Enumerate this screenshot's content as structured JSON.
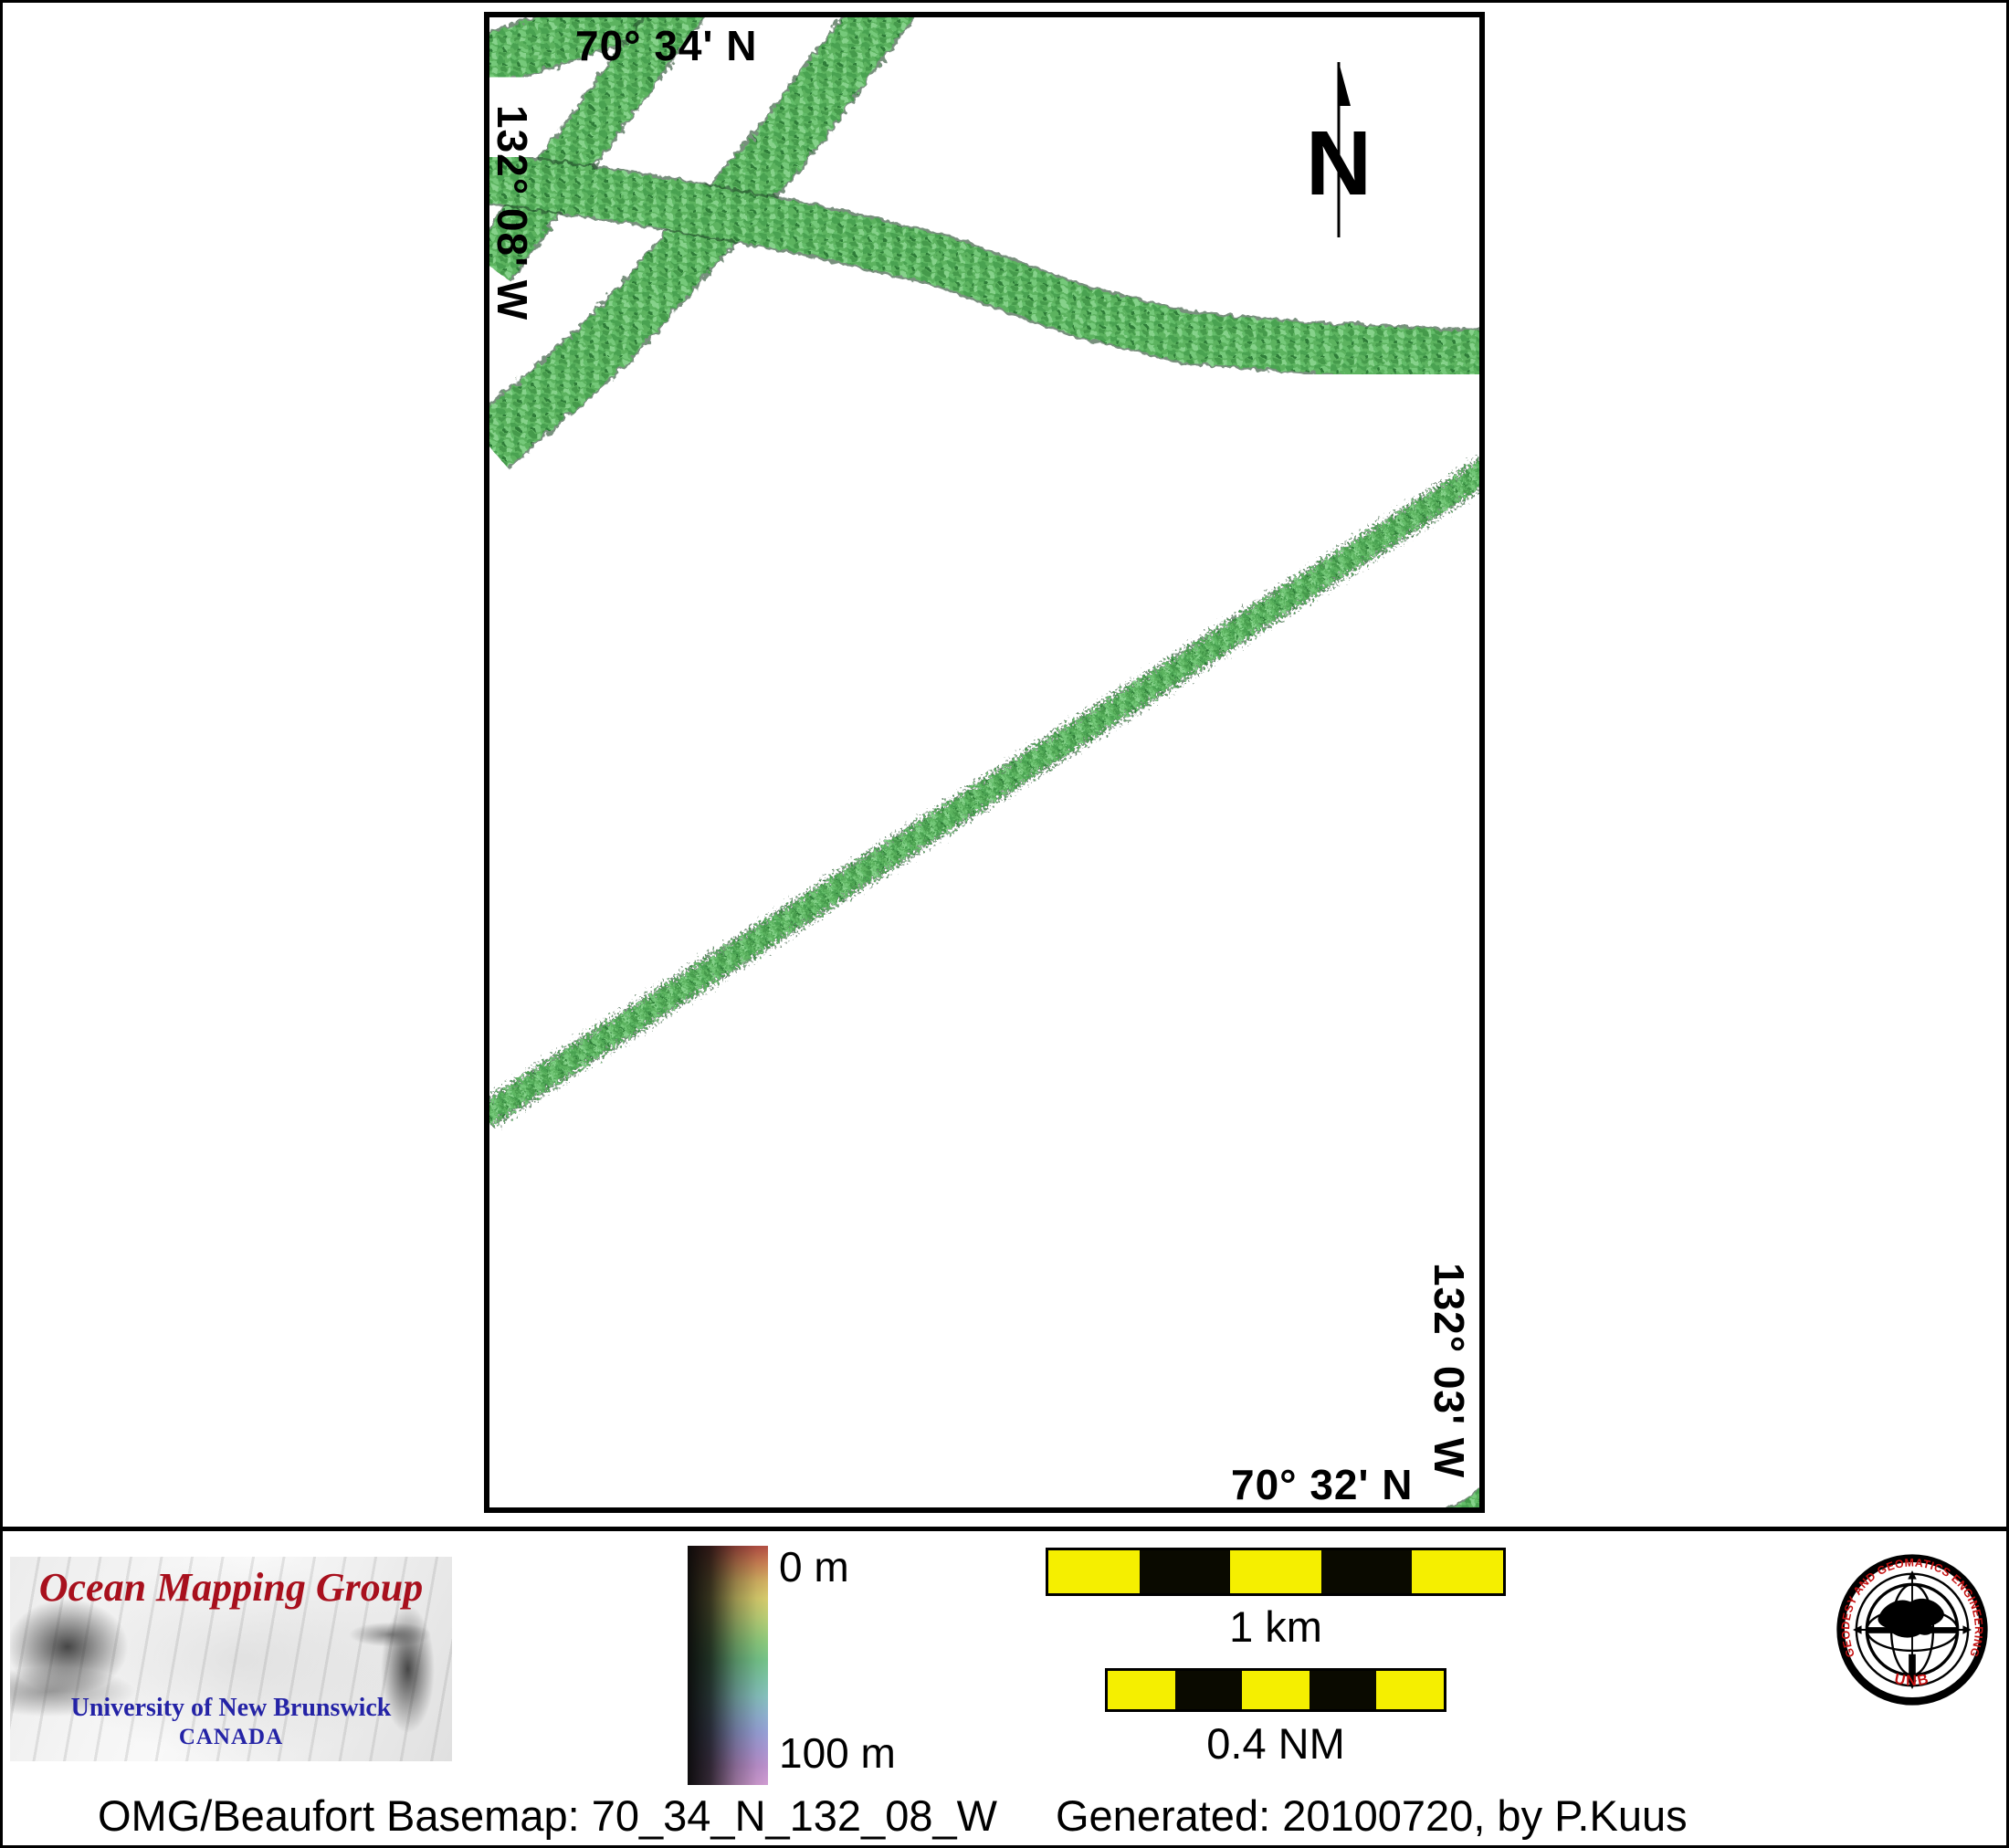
{
  "map": {
    "top_latitude": "70° 34' N",
    "left_longitude": "132° 08' W",
    "right_longitude": "132° 03' W",
    "bottom_latitude": "70° 32' N",
    "north_label": "N",
    "swaths": [
      {
        "name": "corner-swath-nw",
        "w": 56,
        "pts": [
          [
            505,
            75
          ],
          [
            800,
            -20
          ]
        ]
      },
      {
        "name": "steep-swath-west",
        "w": 52,
        "pts": [
          [
            748,
            5
          ],
          [
            537,
            292
          ]
        ]
      },
      {
        "name": "steep-swath-main",
        "w": 62,
        "pts": [
          [
            975,
            0
          ],
          [
            850,
            168
          ],
          [
            660,
            380
          ],
          [
            535,
            488
          ]
        ]
      },
      {
        "name": "wavy-swath-across",
        "w": 54,
        "pts": [
          [
            520,
            192
          ],
          [
            700,
            218
          ],
          [
            880,
            250
          ],
          [
            1030,
            285
          ],
          [
            1180,
            340
          ],
          [
            1300,
            370
          ],
          [
            1450,
            382
          ],
          [
            1630,
            390
          ]
        ]
      },
      {
        "name": "thin-diagonal-swath",
        "w": 25,
        "rough": true,
        "pts": [
          [
            1632,
            512
          ],
          [
            531,
            1222
          ]
        ]
      },
      {
        "name": "corner-swath-se",
        "w": 46,
        "pts": [
          [
            1555,
            1703
          ],
          [
            1705,
            1602
          ]
        ]
      }
    ]
  },
  "legend": {
    "depth_top": "0 m",
    "depth_bottom": "100 m"
  },
  "scalebars": {
    "km_label": "1 km",
    "nm_label": "0.4 NM"
  },
  "branding": {
    "group_name": "Ocean Mapping Group",
    "university": "University of New Brunswick",
    "country": "CANADA",
    "seal_arc_text": "GEODESY AND GEOMATICS ENGINEERING",
    "seal_bottom_text": "UNB"
  },
  "caption": {
    "basemap": "OMG/Beaufort Basemap: 70_34_N_132_08_W",
    "generated": "Generated: 20100720, by P.Kuus"
  },
  "colors": {
    "swath_green": "#5cb35f",
    "swath_green_dark": "#2f7c39",
    "swath_edge": "#1d4524",
    "scalebar_yellow": "#f5ef00",
    "logo_red": "#a8101d",
    "logo_blue": "#2423a6",
    "seal_red": "#c51212"
  }
}
